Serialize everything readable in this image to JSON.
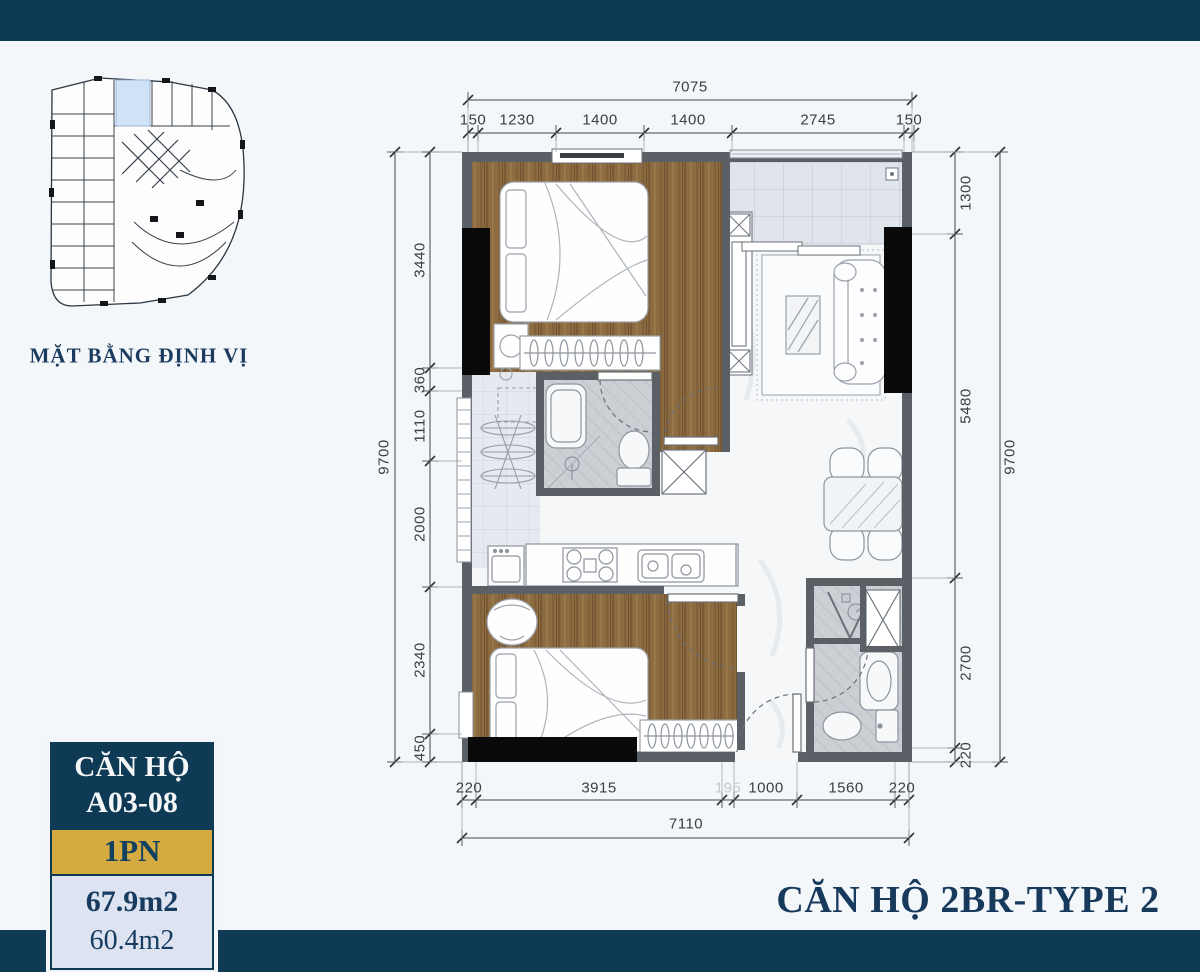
{
  "site_plan": {
    "label": "MẶT BẰNG ĐỊNH VỊ"
  },
  "floor_plan": {
    "dims": {
      "top_total": "7075",
      "top": [
        "150",
        "1230",
        "1400",
        "1400",
        "2745",
        "150"
      ],
      "left_total": "9700",
      "left": [
        "3440",
        "360",
        "1110",
        "2000",
        "2340",
        "450"
      ],
      "right": [
        "1300",
        "5480",
        "2700",
        "220"
      ],
      "right_total": "9700",
      "bottom": [
        "220",
        "3915",
        "195",
        "1000",
        "1560",
        "220"
      ],
      "bottom_total": "7110"
    }
  },
  "info_card": {
    "title": "CĂN HỘ",
    "unit_code": "A03-08",
    "unit_type": "1PN",
    "area_gross": "67.9m2",
    "area_carpet": "60.4m2"
  },
  "plan_title": "CĂN HỘ 2BR-TYPE 2",
  "colors": {
    "navy": "#0e3a53",
    "gold": "#d4aa41",
    "title_text": "#16395c"
  }
}
